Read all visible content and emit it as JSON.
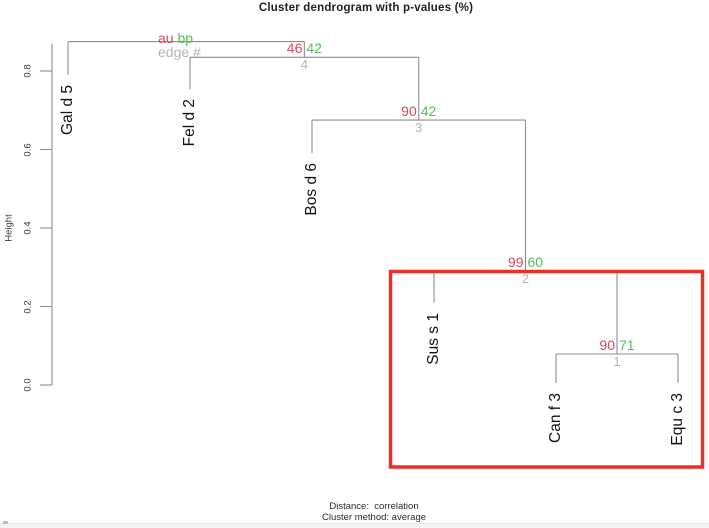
{
  "title": "Cluster dendrogram with p-values (%)",
  "legend": {
    "au_label": "au",
    "bp_label": "bp",
    "edge_label": "edge #"
  },
  "axis": {
    "ylabel": "Height",
    "yticks": [
      "0.0",
      "0.2",
      "0.4",
      "0.6",
      "0.8"
    ]
  },
  "footer": {
    "line1": "Distance:  correlation",
    "line2": "Cluster method: average"
  },
  "colors": {
    "au": "#d6485e",
    "bp": "#53bd58",
    "edge_number": "#b4b4b4",
    "dendro_line": "#8e8e8e",
    "highlight_box": "#ea2f28",
    "leaf_text": "#111111"
  },
  "chart_data": {
    "type": "dendrogram",
    "title": "Cluster dendrogram with p-values (%)",
    "ylabel": "Height",
    "ylim": [
      0.0,
      0.9
    ],
    "yticks": [
      "0.0",
      "0.2",
      "0.4",
      "0.6",
      "0.8"
    ],
    "distance": "correlation",
    "cluster_method": "average",
    "legend_entries": [
      "au",
      "bp",
      "edge #"
    ],
    "leaves": [
      {
        "label": "Gal d 5",
        "hang_to": 0.79
      },
      {
        "label": "Fel d 2",
        "hang_to": 0.754
      },
      {
        "label": "Bos d 6",
        "hang_to": 0.591
      },
      {
        "label": "Sus s 1",
        "hang_to": 0.21
      },
      {
        "label": "Can f 3",
        "hang_to": 0.005
      },
      {
        "label": "Equ c 3",
        "hang_to": 0.005
      }
    ],
    "merges": [
      {
        "edge": 1,
        "children": [
          "Can f 3",
          "Equ c 3"
        ],
        "height": 0.079,
        "au": 90,
        "bp": 71
      },
      {
        "edge": 2,
        "children": [
          "Sus s 1",
          "edge 1"
        ],
        "height": 0.29,
        "au": 99,
        "bp": 60
      },
      {
        "edge": 3,
        "children": [
          "Bos d 6",
          "edge 2"
        ],
        "height": 0.675,
        "au": 90,
        "bp": 42
      },
      {
        "edge": 4,
        "children": [
          "Fel d 2",
          "edge 3"
        ],
        "height": 0.835,
        "au": 46,
        "bp": 42
      },
      {
        "edge": 5,
        "children": [
          "Gal d 5",
          "edge 4"
        ],
        "height": 0.875,
        "au": null,
        "bp": null,
        "root": true
      }
    ],
    "highlight_box_cluster": [
      "Sus s 1",
      "Can f 3",
      "Equ c 3"
    ]
  }
}
